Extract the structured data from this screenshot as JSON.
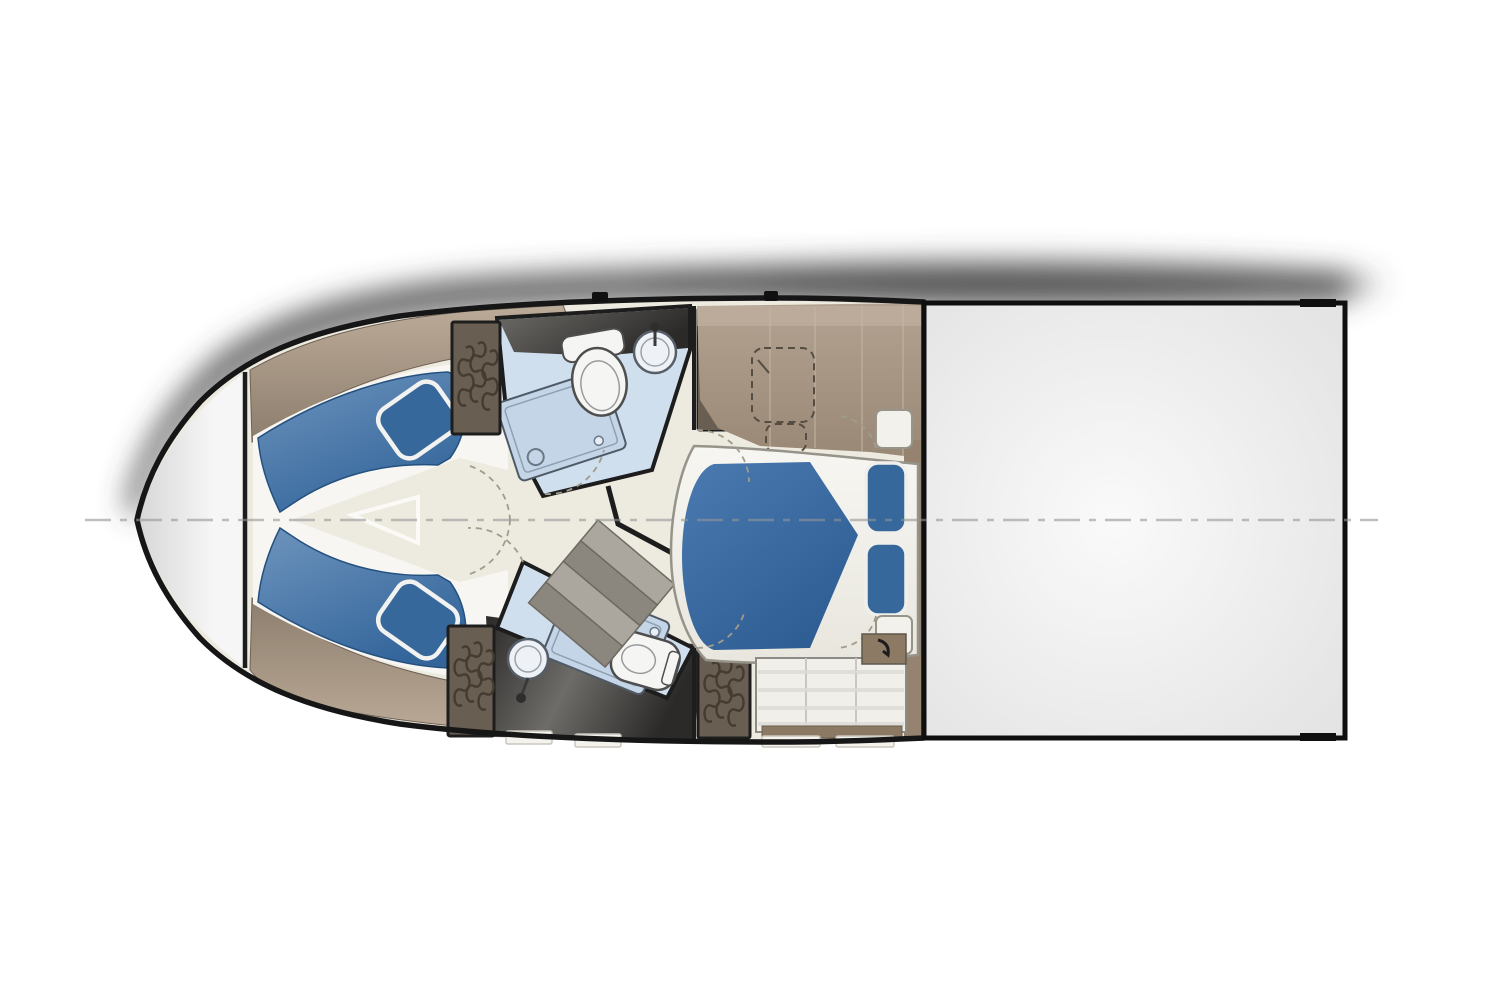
{
  "meta": {
    "description": "Top-down yacht lower-deck floor plan illustration, bow pointing left, no visible text",
    "canvas": {
      "width": 1500,
      "height": 1000
    }
  },
  "colors": {
    "bg": "#ffffff",
    "hull-stroke": "#161616",
    "wall-stroke": "#1d1d1d",
    "bow-deck-light": "#f6f6f6",
    "bow-deck-shade": "#d8d8d8",
    "floor-cream": "#edeadf",
    "floor-cream-shade": "#dfdacb",
    "wood-trim-light": "#bcab99",
    "wood-trim-dark": "#8d7d6c",
    "wood-floor-light": "#b3a291",
    "wood-floor-dark": "#9a8876",
    "plank-seam": "#c6b7a5",
    "wood-strip": "#8c7963",
    "wardrobe-dark": "#695e52",
    "wardrobe-mid": "#8a7c6c",
    "hanger-stroke": "#443c31",
    "berth-white": "#f7f6f3",
    "cushion-light": "#6e94bd",
    "cushion-dark": "#33659b",
    "pillow-blue": "#36689c",
    "bath-blue": "#cfdfee",
    "shower-blue": "#c3d5e6",
    "fixture-white": "#f5f5f3",
    "fixture-stroke": "#4f5a66",
    "marble-light": "#6e6c69",
    "marble-dark": "#2c2a28",
    "stair-gray": "#aba79f",
    "stair-gray-dark": "#8b877f",
    "bed-blue-light": "#4a7ab0",
    "bed-blue-dark": "#2d5d92",
    "platform-white": "#f4f3ee",
    "platform-stroke": "#96938a",
    "dresser-panel": "#f0efea",
    "dresser-seam": "#c9c7c0",
    "aft-deck-light": "#fafafa",
    "aft-deck-shade": "#e2e2e2",
    "centerline": "#969696",
    "dashed-line": "#a19c8b",
    "shadow": "#484848"
  },
  "parts": [
    "hull-outline",
    "bow-deck",
    "centerline-dashed",
    "forward-cabin-v-berth",
    "v-berth-cushion-port",
    "v-berth-cushion-starboard",
    "v-berth-pillow-port",
    "v-berth-pillow-starboard",
    "walkway-wedge",
    "wood-trim-port",
    "wood-trim-starboard",
    "head-forward",
    "shower-forward",
    "toilet-forward",
    "sink-forward",
    "marble-floor-forward",
    "head-aft",
    "shower-aft",
    "toilet-aft",
    "sink-aft",
    "marble-floor-aft",
    "wardrobe-forward-port",
    "wardrobe-forward-starboard",
    "wardrobe-aft-port",
    "wardrobe-aft-starboard",
    "companionway-stairs",
    "master-cabin",
    "master-bed-mattress",
    "master-bed-pillows",
    "bed-platform",
    "desk-dashed-outline",
    "nightstand-upper",
    "nightstand-lower",
    "dresser",
    "wood-floor-master",
    "aft-deck-hatch",
    "drop-shadow"
  ]
}
